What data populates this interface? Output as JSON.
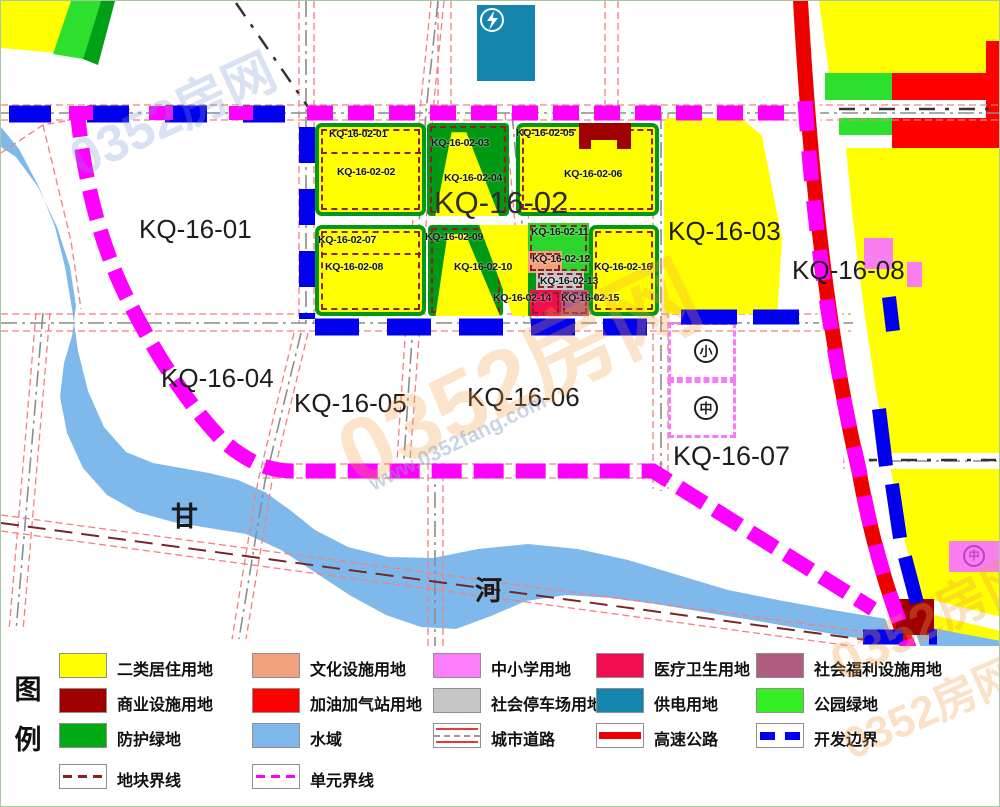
{
  "map": {
    "unit_labels": {
      "k01": "KQ-16-01",
      "k02": "KQ-16-02",
      "k03": "KQ-16-03",
      "k04": "KQ-16-04",
      "k05": "KQ-16-05",
      "k06": "KQ-16-06",
      "k07": "KQ-16-07",
      "k08": "KQ-16-08"
    },
    "parcel_labels": {
      "p01": "KQ-16-02-01",
      "p02": "KQ-16-02-02",
      "p03": "KQ-16-02-03",
      "p04": "KQ-16-02-04",
      "p05": "KQ-16-02-05",
      "p06": "KQ-16-02-06",
      "p07": "KQ-16-02-07",
      "p08": "KQ-16-02-08",
      "p09": "KQ-16-02-09",
      "p10": "KQ-16-02-10",
      "p11": "KQ-16-02-11",
      "p12": "KQ-16-02-12",
      "p13": "KQ-16-02-13",
      "p14": "KQ-16-02-14",
      "p15": "KQ-16-02-15",
      "p16": "KQ-16-02-16"
    },
    "river_name_chars": {
      "first": "甘",
      "second": "河"
    },
    "school_icon_chars": {
      "primary": "小",
      "middle": "中"
    },
    "colors": {
      "residential": "#FFFF00",
      "commercial": "#9E0000",
      "culture": "#F2A17E",
      "school": "#F97EF0",
      "medical": "#F20C50",
      "welfare": "#B05B80",
      "parking": "#C6C6C6",
      "power": "#1485AC",
      "park_green": "#2BD52B",
      "protect_green": "#009914",
      "water": "#7FB9EC",
      "highway": "#ED0000",
      "dev_boundary": "#0000EE",
      "unit_boundary": "#FF00FF",
      "parcel_line": "#8B2121"
    }
  },
  "legend": {
    "title_chars": {
      "first": "图",
      "second": "例"
    },
    "items": [
      {
        "key": "residential",
        "label": "二类居住用地",
        "swatch": {
          "type": "fill",
          "color": "#FFFF00"
        }
      },
      {
        "key": "culture",
        "label": "文化设施用地",
        "swatch": {
          "type": "fill",
          "color": "#F2A17E"
        }
      },
      {
        "key": "school",
        "label": "中小学用地",
        "swatch": {
          "type": "fill",
          "color": "#FC7EFC"
        }
      },
      {
        "key": "medical",
        "label": "医疗卫生用地",
        "swatch": {
          "type": "fill",
          "color": "#F20C50"
        }
      },
      {
        "key": "welfare",
        "label": "社会福利设施用地",
        "swatch": {
          "type": "fill",
          "color": "#B05B80"
        }
      },
      {
        "key": "commercial",
        "label": "商业设施用地",
        "swatch": {
          "type": "fill",
          "color": "#9E0000"
        }
      },
      {
        "key": "gas-station",
        "label": "加油加气站用地",
        "swatch": {
          "type": "fill",
          "color": "#FF0000"
        }
      },
      {
        "key": "parking",
        "label": "社会停车场用地",
        "swatch": {
          "type": "fill",
          "color": "#C6C6C6"
        }
      },
      {
        "key": "power",
        "label": "供电用地",
        "swatch": {
          "type": "fill",
          "color": "#1485AC"
        }
      },
      {
        "key": "park-green",
        "label": "公园绿地",
        "swatch": {
          "type": "fill",
          "color": "#33EE22"
        }
      },
      {
        "key": "protect-green",
        "label": "防护绿地",
        "swatch": {
          "type": "fill",
          "color": "#00AA14"
        }
      },
      {
        "key": "water",
        "label": "水域",
        "swatch": {
          "type": "fill",
          "color": "#7FB9EC"
        }
      },
      {
        "key": "city-road",
        "label": "城市道路",
        "swatch": {
          "type": "road"
        }
      },
      {
        "key": "highway",
        "label": "高速公路",
        "swatch": {
          "type": "highway"
        }
      },
      {
        "key": "dev-boundary",
        "label": "开发边界",
        "swatch": {
          "type": "dev"
        }
      },
      {
        "key": "parcel-line",
        "label": "地块界线",
        "swatch": {
          "type": "parcel"
        }
      },
      {
        "key": "unit-line",
        "label": "单元界线",
        "swatch": {
          "type": "unit"
        }
      }
    ]
  },
  "watermark": {
    "brand": "0352房网",
    "url": "www.0352fang.com"
  }
}
